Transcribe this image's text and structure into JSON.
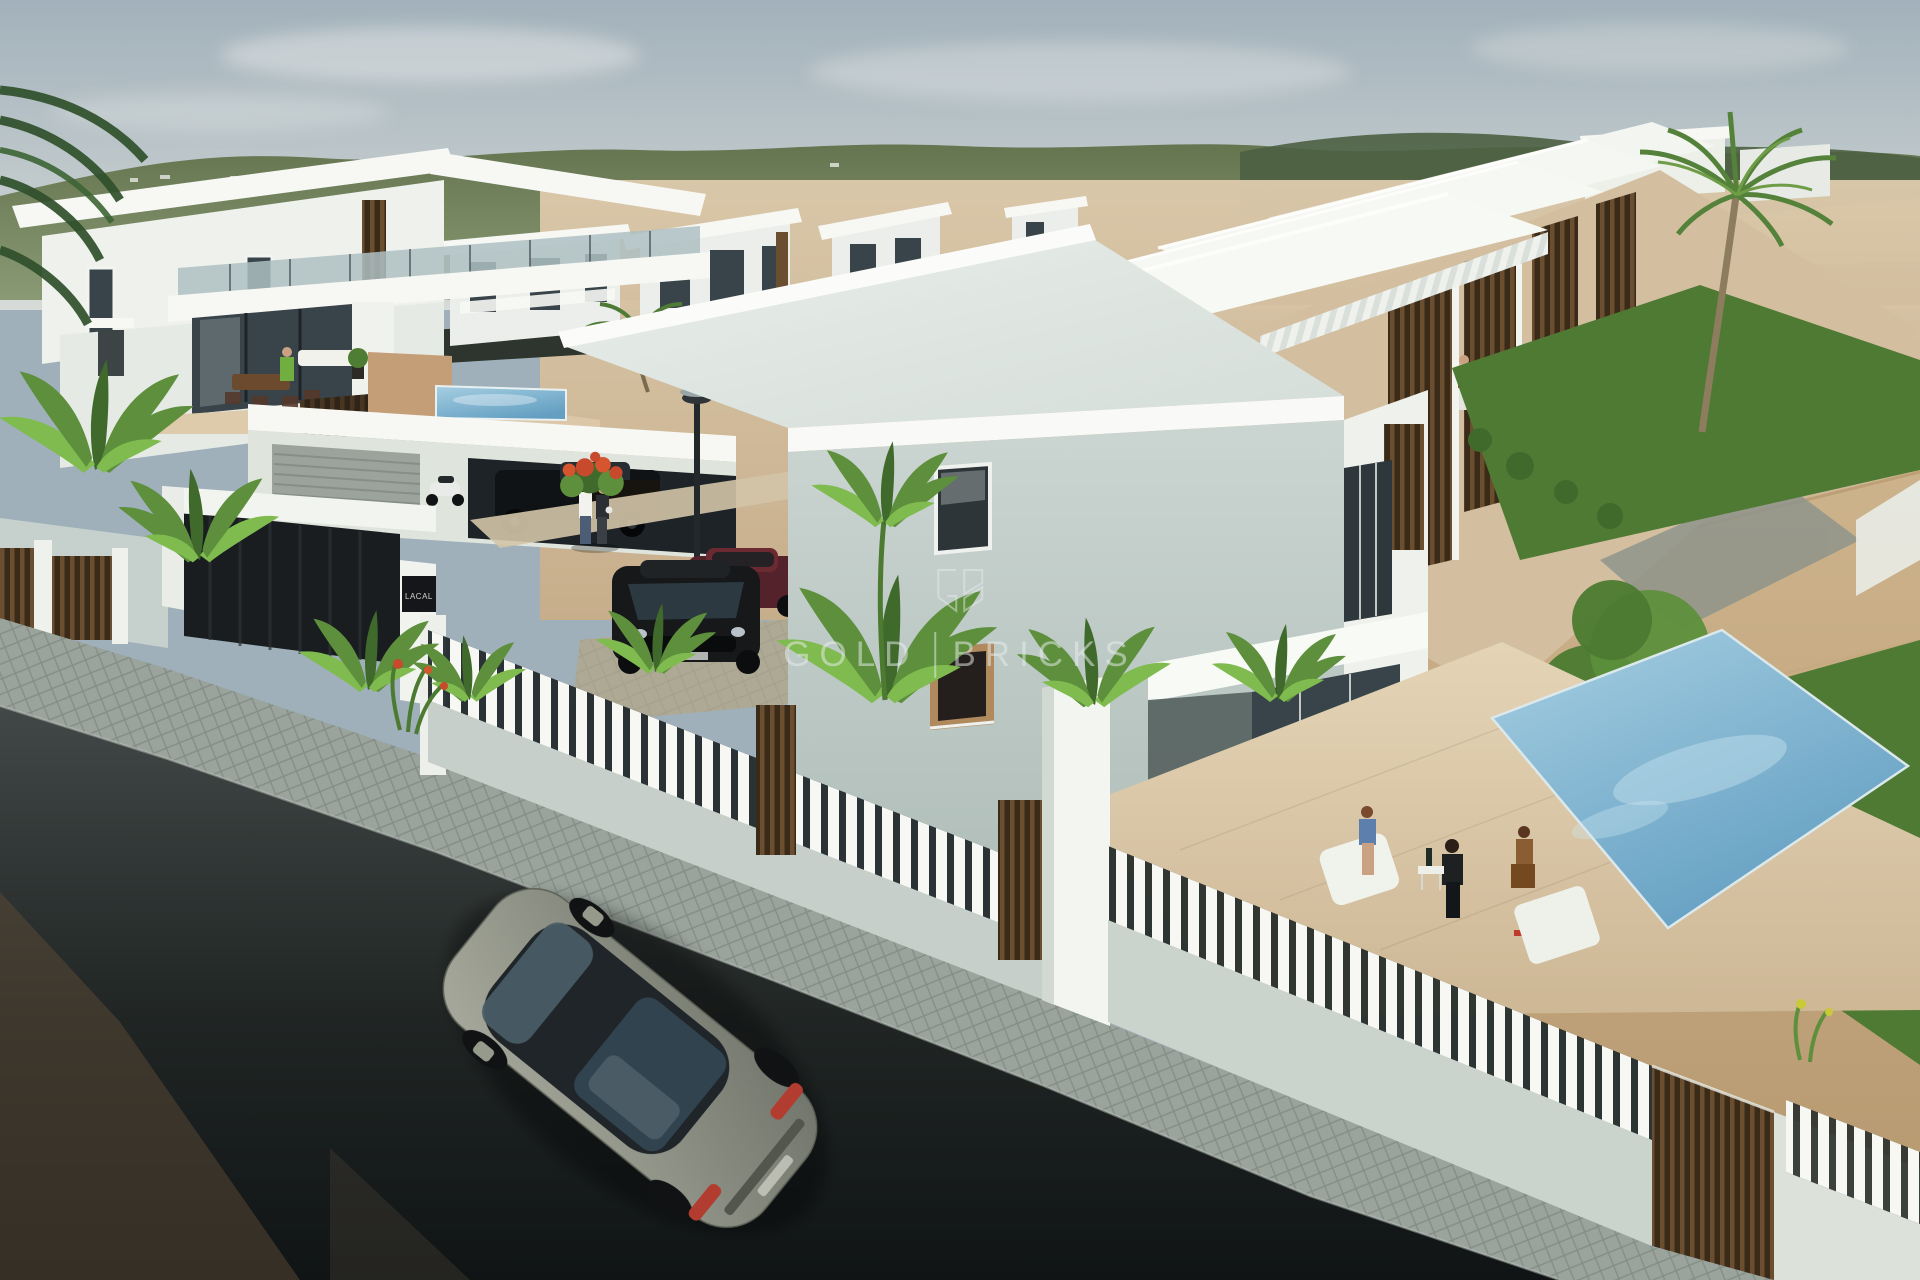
{
  "watermark": {
    "brand_word_1": "GOLD",
    "brand_word_2": "BRICKS",
    "logo": "gold-bricks-monogram-icon"
  },
  "signs": {
    "gate_plaque": "LACAL"
  },
  "palette": {
    "sky_top": "#a2b1bb",
    "sky_low": "#d6dbd8",
    "cloud": "#e9ece9",
    "hill_green": "#64754f",
    "hill_light": "#8a9a74",
    "hill_dark": "#4d6042",
    "meadow": "#9aa87b",
    "sand_light": "#dcc9ab",
    "sand": "#c8ad89",
    "sand_deep": "#bfa078",
    "white_sun": "#f7f8f4",
    "white_wall": "#ebeeea",
    "wall_shade": "#c6d0cd",
    "wall_deep": "#a9b8b4",
    "frame_dark": "#2e3538",
    "glass_dark": "#39444a",
    "glass_sky": "#aebfc2",
    "wood": "#6b4e30",
    "wood_dark": "#3a2a18",
    "asphalt_light": "#424847",
    "asphalt": "#14181a",
    "earth_streak": "#5c4936",
    "cobble": "#9aa49d",
    "cobble_line": "#77827a",
    "deck": "#dcc9a9",
    "deck_shade": "#cdb896",
    "pool_light": "#9cc8de",
    "pool_deep": "#6ba6c6",
    "lawn": "#4e7a33",
    "leaf": "#5d8f3c",
    "leaf_light": "#7fbb4f",
    "leaf_dark": "#3f6a2c",
    "trunk": "#8d7c5e",
    "car_body": "#969a8b",
    "car_glass": "#222930",
    "tail_red": "#b23c30",
    "flower_red": "#c84a2c",
    "skin": "#caa183",
    "red_shirt": "#b4402f",
    "blue_shirt": "#5d7fae",
    "brown_dress": "#8a5d33",
    "watermark_ink": "rgba(232,238,238,0.52)"
  }
}
